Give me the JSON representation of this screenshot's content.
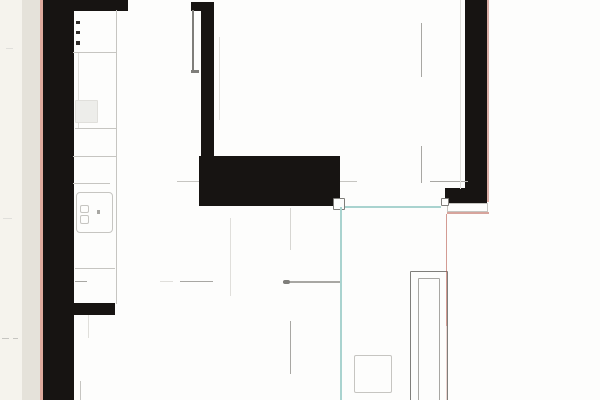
{
  "document": {
    "kind": "scanned-floor-plan-drawing",
    "visible_text": ""
  },
  "colors": {
    "paper": "#fdfdfc",
    "wall": "#171412",
    "margin_outer": "#f5f3ed",
    "margin_inner": "#e5e2da",
    "pink": "#dfab9e",
    "teal": "#a9d3cf",
    "red": "#b14b3c",
    "line_faint": "#e0dfdb",
    "line_light": "#c6c5c1",
    "line_mid": "#a8a7a3",
    "line_dark": "#7f7e7a",
    "fixture": "#ededea",
    "dot": "#2f2c29"
  },
  "strips": [
    {
      "id": "page-margin-outer",
      "x": 0,
      "y": 0,
      "w": 22,
      "h": 400,
      "color": "margin_outer"
    },
    {
      "id": "page-margin-inner",
      "x": 22,
      "y": 0,
      "w": 18,
      "h": 400,
      "color": "margin_inner"
    },
    {
      "id": "page-edge-pink-line",
      "x": 40,
      "y": 0,
      "w": 2.5,
      "h": 400,
      "color": "pink"
    }
  ],
  "walls": [
    {
      "id": "wall-left",
      "x": 42.5,
      "y": 0,
      "w": 31,
      "h": 400,
      "color": "wall"
    },
    {
      "id": "wall-top-left",
      "x": 62,
      "y": 0,
      "w": 66,
      "h": 10.5,
      "color": "wall"
    },
    {
      "id": "wall-kitchen-stub",
      "x": 63,
      "y": 303,
      "w": 52,
      "h": 12,
      "color": "wall"
    },
    {
      "id": "wall-center-cap",
      "x": 191,
      "y": 2,
      "w": 22.5,
      "h": 8.5,
      "color": "wall"
    },
    {
      "id": "wall-center",
      "x": 201,
      "y": 2,
      "w": 12.5,
      "h": 156,
      "color": "wall"
    },
    {
      "id": "wall-center-block",
      "x": 199,
      "y": 156,
      "w": 141,
      "h": 50,
      "color": "wall"
    },
    {
      "id": "wall-right",
      "x": 465,
      "y": 0,
      "w": 22,
      "h": 202,
      "color": "wall"
    },
    {
      "id": "wall-right-foot",
      "x": 445,
      "y": 188,
      "w": 42,
      "h": 15,
      "color": "wall"
    }
  ],
  "lines": [
    {
      "id": "counter-front-line",
      "x": 115.5,
      "y": 10,
      "w": 1.2,
      "h": 294,
      "color": "line_light"
    },
    {
      "id": "counter-inner-line",
      "x": 78,
      "y": 53,
      "w": 1,
      "h": 75,
      "color": "line_faint"
    },
    {
      "id": "counter-divider-1",
      "x": 73,
      "y": 52,
      "w": 44,
      "h": 1.1,
      "color": "line_light"
    },
    {
      "id": "counter-divider-2",
      "x": 75,
      "y": 128,
      "w": 41,
      "h": 1.2,
      "color": "line_light"
    },
    {
      "id": "counter-divider-3",
      "x": 73,
      "y": 156,
      "w": 43,
      "h": 1.2,
      "color": "line_light"
    },
    {
      "id": "counter-divider-4",
      "x": 73,
      "y": 183,
      "w": 37,
      "h": 1.2,
      "color": "line_light"
    },
    {
      "id": "counter-divider-5",
      "x": 75,
      "y": 268,
      "w": 40,
      "h": 1.2,
      "color": "line_light"
    },
    {
      "id": "dash-line-281-a",
      "x": 75,
      "y": 281,
      "w": 12,
      "h": 1.2,
      "color": "line_mid"
    },
    {
      "id": "dash-line-281-b",
      "x": 160,
      "y": 281,
      "w": 13,
      "h": 1,
      "color": "line_faint"
    },
    {
      "id": "dash-line-281-c",
      "x": 180,
      "y": 281,
      "w": 33,
      "h": 1.4,
      "color": "line_mid"
    },
    {
      "id": "dash-line-281-d",
      "x": 283,
      "y": 281,
      "w": 57,
      "h": 1.5,
      "color": "line_mid"
    },
    {
      "id": "dash-arrowhead",
      "x": 283,
      "y": 279.5,
      "w": 7,
      "h": 4,
      "color": "line_dark",
      "r": 2
    },
    {
      "id": "dash-line-181-a",
      "x": 177,
      "y": 181,
      "w": 22,
      "h": 1.2,
      "color": "line_light"
    },
    {
      "id": "dash-line-181-b",
      "x": 340,
      "y": 181,
      "w": 17,
      "h": 1.2,
      "color": "line_light"
    },
    {
      "id": "dash-line-181-c",
      "x": 430,
      "y": 181,
      "w": 38,
      "h": 1.2,
      "color": "line_mid"
    },
    {
      "id": "door-jamb-line-upper",
      "x": 421,
      "y": 23,
      "w": 1.2,
      "h": 54,
      "color": "line_mid"
    },
    {
      "id": "door-jamb-line-lower",
      "x": 420.5,
      "y": 146,
      "w": 1.2,
      "h": 37,
      "color": "line_mid"
    },
    {
      "id": "right-wall-inner-line",
      "x": 460,
      "y": 0,
      "w": 1,
      "h": 189,
      "color": "line_faint"
    },
    {
      "id": "center-faint-line",
      "x": 219,
      "y": 37,
      "w": 1,
      "h": 83,
      "color": "line_faint"
    },
    {
      "id": "mid-room-faint-line",
      "x": 230,
      "y": 218,
      "w": 1,
      "h": 78,
      "color": "line_faint"
    },
    {
      "id": "dash-v-290-upper",
      "x": 290,
      "y": 208,
      "w": 1,
      "h": 42,
      "color": "line_light",
      "opacity": 0.7
    },
    {
      "id": "dash-v-290-lower",
      "x": 289.5,
      "y": 321,
      "w": 1.6,
      "h": 53,
      "color": "line_mid"
    },
    {
      "id": "door-leaf-line",
      "x": 192,
      "y": 10,
      "w": 1.8,
      "h": 62,
      "color": "line_dark"
    },
    {
      "id": "door-leaf-foot",
      "x": 190.5,
      "y": 69.5,
      "w": 8,
      "h": 3.2,
      "color": "line_dark"
    },
    {
      "id": "margin-smudge-1",
      "x": 2,
      "y": 338,
      "w": 7,
      "h": 1.2,
      "color": "line_light"
    },
    {
      "id": "margin-smudge-2",
      "x": 13,
      "y": 338,
      "w": 5,
      "h": 1,
      "color": "line_light"
    },
    {
      "id": "margin-smudge-3",
      "x": 3,
      "y": 218,
      "w": 9,
      "h": 1,
      "color": "line_faint"
    },
    {
      "id": "margin-smudge-4",
      "x": 6,
      "y": 48,
      "w": 7,
      "h": 1,
      "color": "line_faint"
    },
    {
      "id": "faint-line-under-stub-a",
      "x": 88,
      "y": 315,
      "w": 1,
      "h": 23,
      "color": "line_faint"
    },
    {
      "id": "faint-line-under-stub-b",
      "x": 79.5,
      "y": 381,
      "w": 1,
      "h": 19,
      "color": "line_light"
    }
  ],
  "boxes": [
    {
      "id": "cooktop",
      "x": 75,
      "y": 100,
      "w": 23,
      "h": 23,
      "fill": "fixture",
      "stroke": "line_faint",
      "sw": 1,
      "r": 1
    },
    {
      "id": "sink",
      "x": 76,
      "y": 192,
      "w": 37,
      "h": 41,
      "fill": "paper",
      "stroke": "line_light",
      "sw": 1.6,
      "r": 4
    },
    {
      "id": "sink-faucet-upper",
      "x": 80,
      "y": 205,
      "w": 9,
      "h": 8,
      "stroke": "line_light",
      "sw": 1.2,
      "r": 2
    },
    {
      "id": "sink-faucet-lower",
      "x": 80,
      "y": 215,
      "w": 9,
      "h": 9,
      "stroke": "line_light",
      "sw": 1.2,
      "r": 2
    },
    {
      "id": "threshold-sill",
      "x": 447,
      "y": 203,
      "w": 41,
      "h": 9,
      "stroke": "line_light",
      "sw": 1.2,
      "r": 0
    },
    {
      "id": "corner-marker-block",
      "x": 332.5,
      "y": 197.5,
      "w": 12.5,
      "h": 12,
      "fill": "paper",
      "stroke": "line_dark",
      "sw": 1.6,
      "r": 1
    },
    {
      "id": "corner-marker-right",
      "x": 441,
      "y": 197.5,
      "w": 8,
      "h": 8.5,
      "fill": "paper",
      "stroke": "line_dark",
      "sw": 1.4,
      "r": 1
    },
    {
      "id": "floor-square",
      "x": 353.5,
      "y": 355,
      "w": 38.5,
      "h": 38,
      "fill": "paper",
      "stroke": "line_light",
      "sw": 1.8,
      "r": 2
    },
    {
      "id": "shaft-outer-frame",
      "x": 410,
      "y": 270.5,
      "w": 38,
      "h": 133,
      "stroke": "line_dark",
      "sw": 1.7,
      "r": 1
    },
    {
      "id": "shaft-inner-frame",
      "x": 418,
      "y": 278,
      "w": 22,
      "h": 126,
      "stroke": "line_mid",
      "sw": 1.4,
      "r": 1
    }
  ],
  "dots": [
    {
      "id": "wall-dot-1",
      "x": 76,
      "y": 20.5,
      "w": 4,
      "h": 3.5,
      "color": "dot"
    },
    {
      "id": "wall-dot-2",
      "x": 76,
      "y": 30.5,
      "w": 4,
      "h": 3.5,
      "color": "dot"
    },
    {
      "id": "wall-dot-3",
      "x": 76,
      "y": 41,
      "w": 4,
      "h": 3.5,
      "color": "dot"
    },
    {
      "id": "sink-knob-dot",
      "x": 96.5,
      "y": 210,
      "w": 3.5,
      "h": 3.5,
      "color": "line_mid"
    }
  ],
  "overlays": [
    {
      "id": "teal-reference-line-h",
      "x": 345,
      "y": 205.5,
      "w": 96,
      "h": 2.2,
      "color": "teal"
    },
    {
      "id": "teal-reference-line-v",
      "x": 340,
      "y": 207,
      "w": 2.2,
      "h": 193,
      "color": "teal"
    },
    {
      "id": "red-scan-line-wall-edge",
      "x": 487,
      "y": 0,
      "w": 2,
      "h": 202,
      "color": "red",
      "opacity": 0.45
    },
    {
      "id": "red-scan-line-threshold",
      "x": 447,
      "y": 212,
      "w": 42,
      "h": 1.8,
      "color": "red",
      "opacity": 0.5
    },
    {
      "id": "red-scan-line-v",
      "x": 445.5,
      "y": 214,
      "w": 1.6,
      "h": 112,
      "color": "red",
      "opacity": 0.55
    },
    {
      "id": "red-scan-line-v-faint",
      "x": 446,
      "y": 326,
      "w": 1.2,
      "h": 74,
      "color": "red",
      "opacity": 0.22
    }
  ]
}
